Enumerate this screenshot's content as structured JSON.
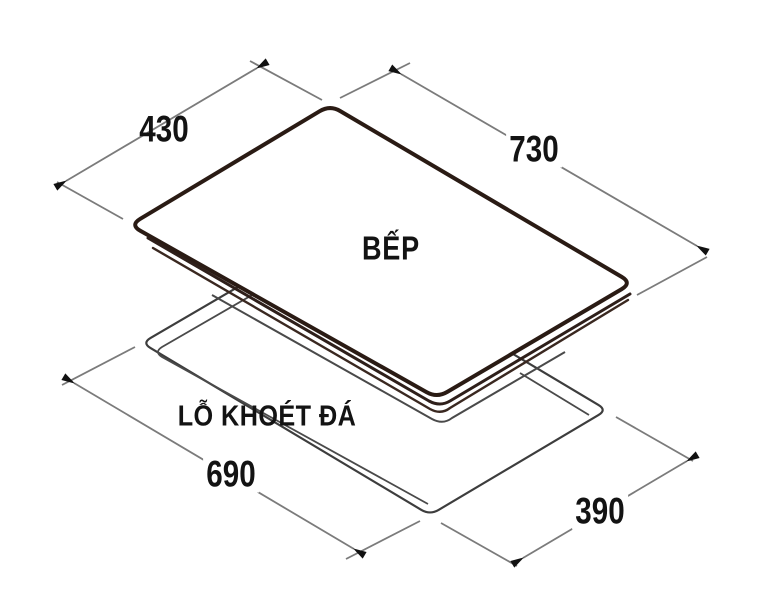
{
  "diagram": {
    "cooktop_label": "BẾP",
    "cutout_label": "LỖ KHOÉT ĐÁ",
    "dimensions": {
      "cooktop_width": "430",
      "cooktop_length": "730",
      "cutout_length": "690",
      "cutout_width": "390"
    },
    "colors": {
      "background": "#ffffff",
      "outline": "#2a1b14",
      "glass_band": "#2e1f1a",
      "thin_line": "#3d3d3d",
      "body_line": "#4a4a4a",
      "dim_line": "#7b7b7b",
      "arrow": "#111111",
      "text": "#131313"
    }
  }
}
